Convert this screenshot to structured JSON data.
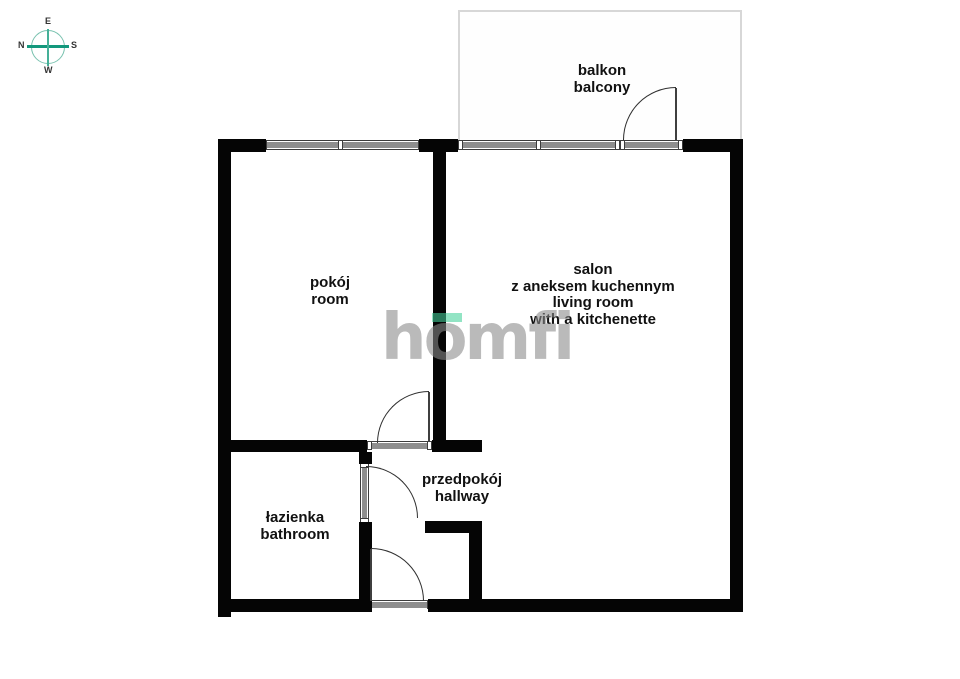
{
  "compass": {
    "e": "E",
    "n": "N",
    "s": "S",
    "w": "W"
  },
  "balcony": {
    "label_pl": "balkon",
    "label_en": "balcony"
  },
  "rooms": {
    "pokoj": {
      "label_pl": "pokój",
      "label_en": "room"
    },
    "salon": {
      "label_pl_1": "salon",
      "label_pl_2": "z aneksem kuchennym",
      "label_en_1": "living room",
      "label_en_2": "with a kitchenette"
    },
    "przedpokoj": {
      "label_pl": "przedpokój",
      "label_en": "hallway"
    },
    "lazienka": {
      "label_pl": "łazienka",
      "label_en": "bathroom"
    }
  },
  "watermark": {
    "brand": "homfi"
  },
  "colors": {
    "wall": "#050505",
    "window_fill": "#8e8e8e",
    "accent_green": "#45d19b",
    "compass_teal": "#13987c",
    "watermark_gray": "#8a8a8a",
    "balcony_outline": "#d7d7d7"
  }
}
